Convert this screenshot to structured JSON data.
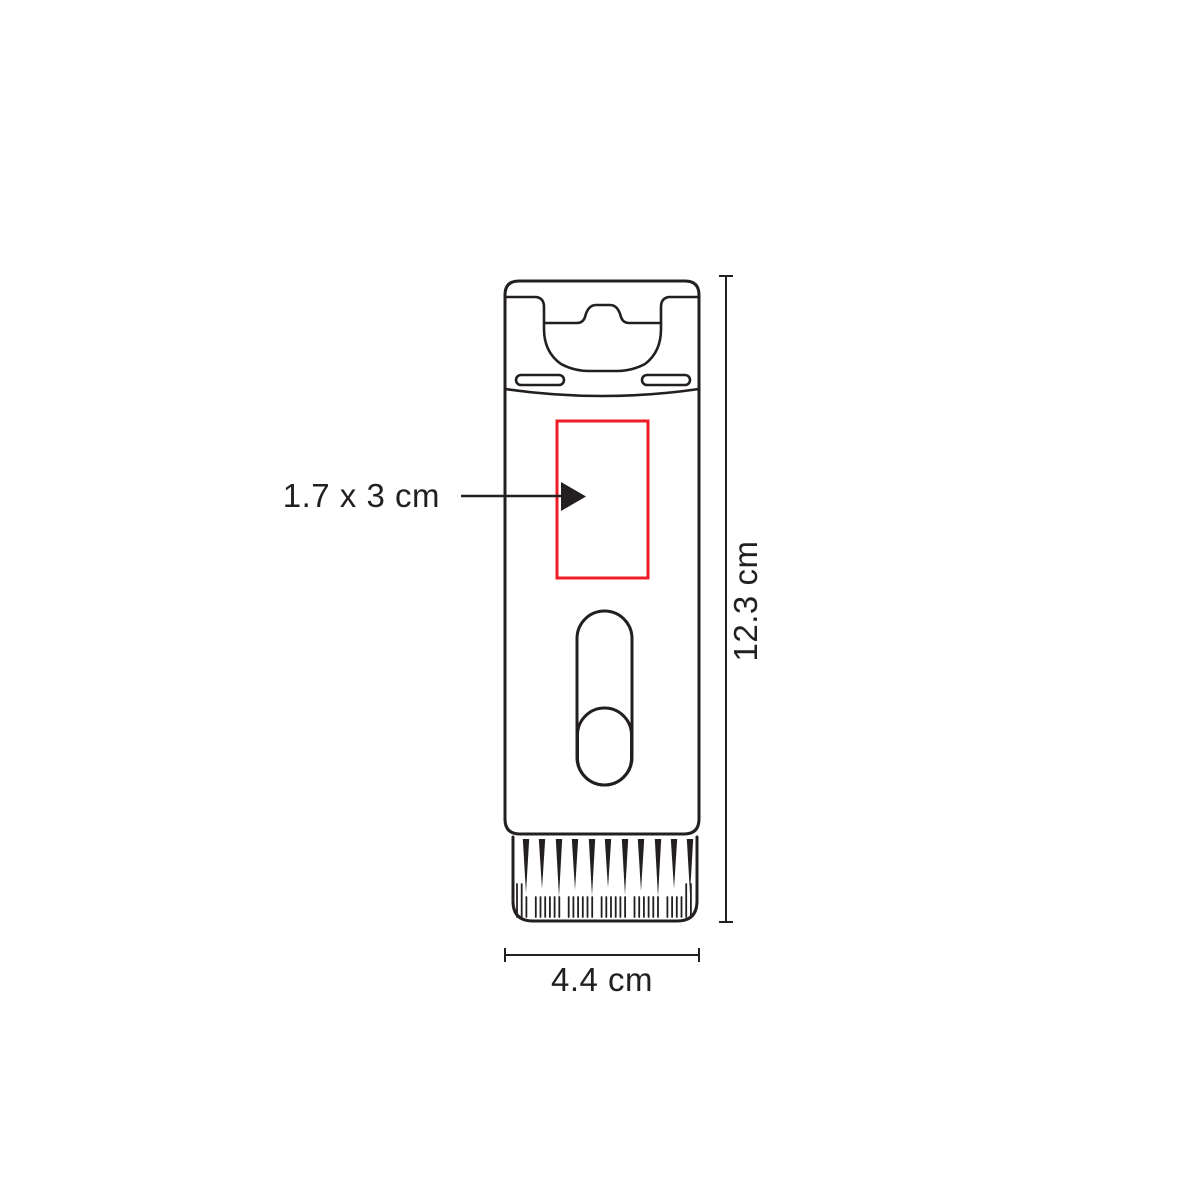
{
  "annotations": {
    "imprint_area": "1.7 x 3 cm",
    "height": "12.3 cm",
    "width": "4.4 cm"
  },
  "colors": {
    "line": "#231f20",
    "imprint_box": "#ee1c25",
    "background": "#ffffff"
  }
}
